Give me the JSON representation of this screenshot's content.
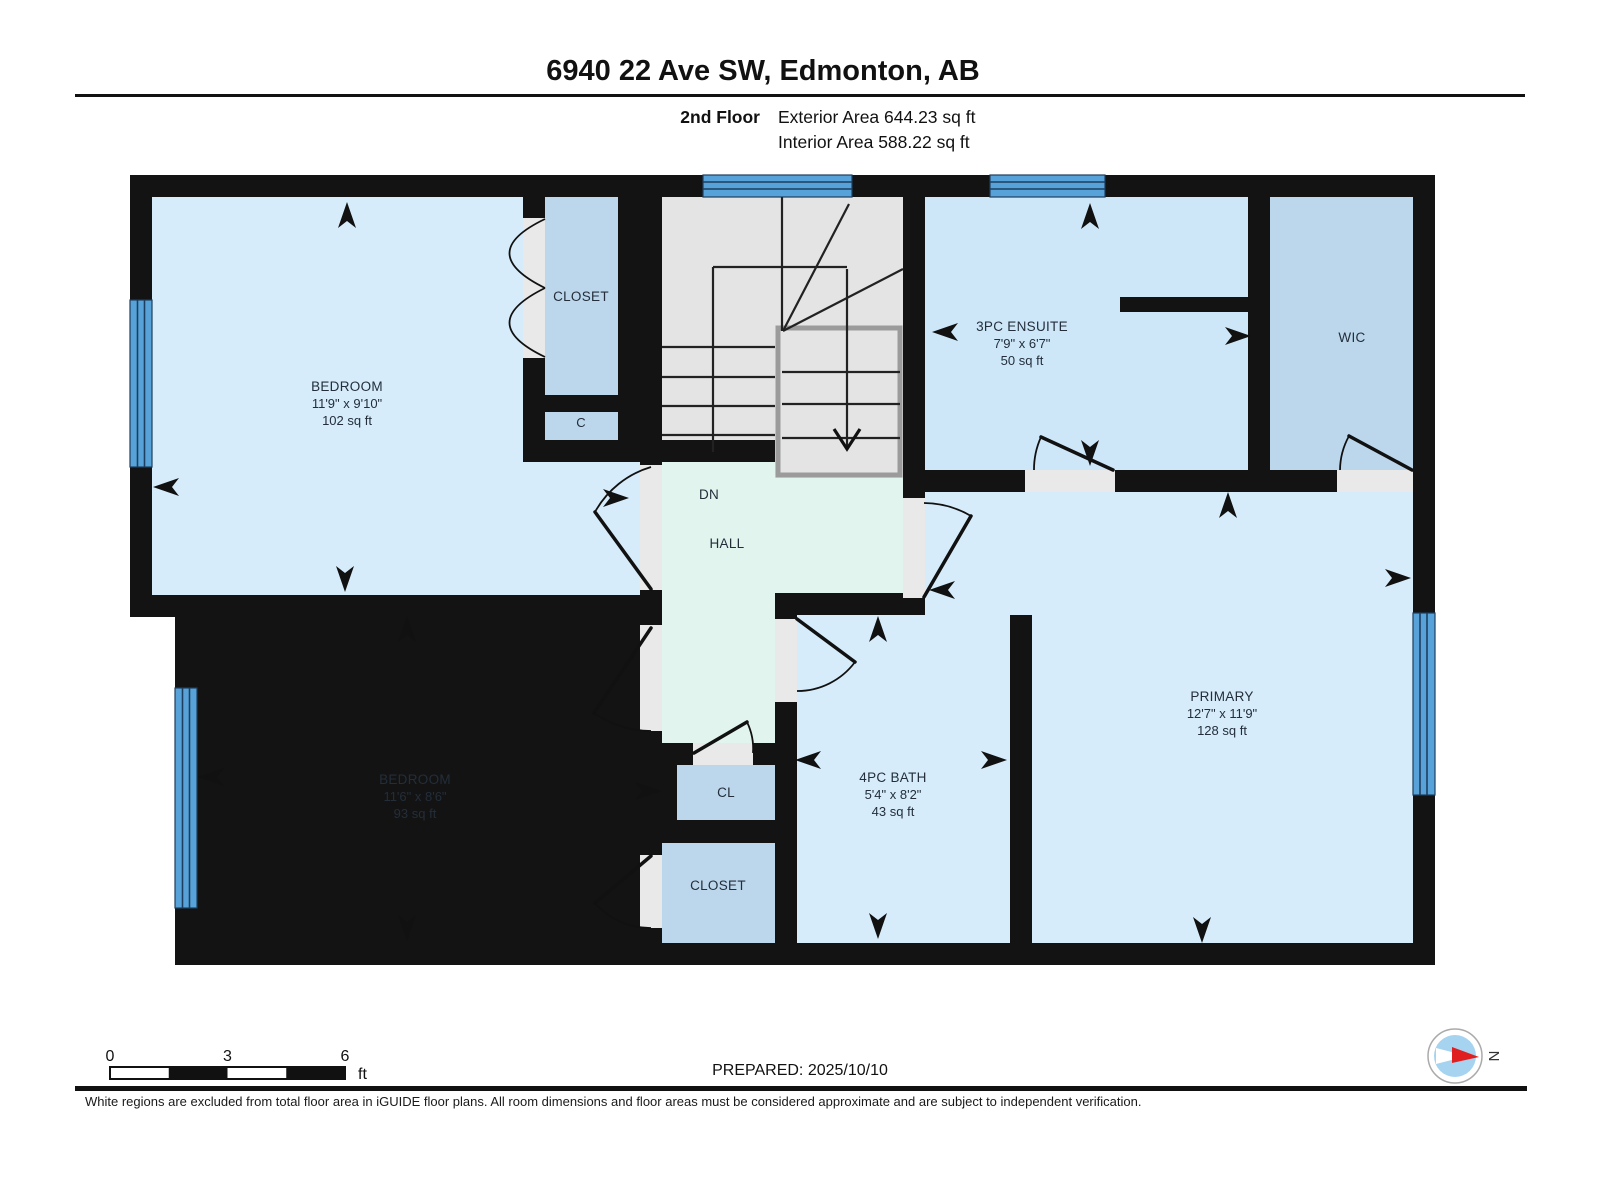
{
  "header": {
    "title": "6940 22 Ave SW, Edmonton, AB",
    "floor_label": "2nd Floor",
    "exterior_area": "Exterior Area 644.23 sq ft",
    "interior_area": "Interior Area 588.22 sq ft"
  },
  "rooms": {
    "bedroom_top": {
      "name": "BEDROOM",
      "dims": "11'9\" x 9'10\"",
      "area": "102 sq ft"
    },
    "bedroom_bottom": {
      "name": "BEDROOM",
      "dims": "11'6\" x 8'6\"",
      "area": "93 sq ft"
    },
    "ensuite": {
      "name": "3PC ENSUITE",
      "dims": "7'9\" x 6'7\"",
      "area": "50 sq ft"
    },
    "bath": {
      "name": "4PC BATH",
      "dims": "5'4\" x 8'2\"",
      "area": "43 sq ft"
    },
    "primary": {
      "name": "PRIMARY",
      "dims": "12'7\" x 11'9\"",
      "area": "128 sq ft"
    },
    "wic": {
      "name": "WIC"
    },
    "closet_top": {
      "name": "CLOSET"
    },
    "closet_small": {
      "name": "C"
    },
    "cl": {
      "name": "CL"
    },
    "closet_bottom": {
      "name": "CLOSET"
    },
    "hall": {
      "name": "HALL",
      "stair_direction": "DN"
    }
  },
  "footer": {
    "scale_ticks": {
      "start": "0",
      "mid": "3",
      "end": "6"
    },
    "scale_unit": "ft",
    "prepared": "PREPARED: 2025/10/10",
    "compass_north": "N",
    "disclaimer": "White regions are excluded from total floor area in iGUIDE floor plans. All room dimensions and floor areas must be considered approximate and are subject to independent verification."
  },
  "colors": {
    "wall": "#131313",
    "room_blue": "#d6ecfa",
    "ensuite_blue": "#cde7f9",
    "closet_blue": "#bcd7ec",
    "hall_green": "#e2f4ee",
    "stair_gray": "#e4e4e4",
    "window_blue": "#57a3d9",
    "door_threshold": "#e9e9e9",
    "compass_red": "#e02020",
    "label_text": "#232e3a"
  }
}
